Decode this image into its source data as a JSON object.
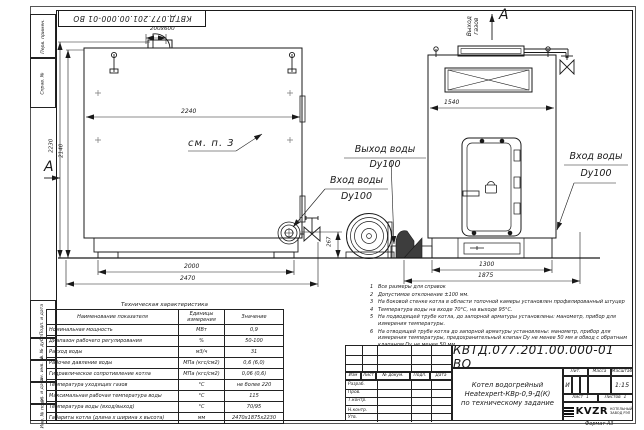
{
  "sheet": {
    "top_stamp": "КВТД.077.201.00.000-01 ВО",
    "format_note": "Формат А3",
    "side_labels": {
      "perv_primen": "Перв. примен.",
      "sprav_no": "Справ. №",
      "podp_data_1": "Подп. и дата",
      "inv_dubl": "Инв. № дубл.",
      "vzam_inv": "Взам. инв. №",
      "podp_data_2": "Подп. и дата",
      "inv_podl": "Инв. № подл."
    }
  },
  "drawing": {
    "left_view": {
      "dim_opening": "200x600",
      "dim_width_inner": "2240",
      "dim_height_overall": "2230",
      "dim_height_body": "2140",
      "dim_base": "2000",
      "dim_overall": "2470",
      "dim_flange_h": "267",
      "see_note": "см. п. 3",
      "section_label": "А"
    },
    "right_view": {
      "dim_width": "1540",
      "dim_base": "1300",
      "dim_overall": "1875",
      "flue_word1": "Выход",
      "flue_word2": "газов",
      "view_label": "А"
    },
    "callouts": {
      "water_out_line1": "Выход воды",
      "water_out_line2": "Dy100",
      "water_in_left_line1": "Вход воды",
      "water_in_left_line2": "Dy100",
      "water_in_right_line1": "Вход воды",
      "water_in_right_line2": "Dy100"
    }
  },
  "notes": {
    "items": [
      {
        "num": "1",
        "text": "Все размеры для справок"
      },
      {
        "num": "2",
        "text": "Допустимое отклонение ±100 мм."
      },
      {
        "num": "3",
        "text": "На боковой стенке котла в области топочной камеры установлен профилированный штуцер"
      },
      {
        "num": "4",
        "text": "Температура воды на входе 70°С, на выходе 95°С."
      },
      {
        "num": "5",
        "text": "На подводящей трубе котла, до запорной арматуры установлены: манометр, прибор для измерения температуры."
      },
      {
        "num": "6",
        "text": "На отводящей трубе котла до запорной арматуры установлены: манометр, прибор для измерения температуры, предохранительный клапан Dу не менее 50 мм и обвод с обратным клапаном Dу не менее 50 мм."
      },
      {
        "num": "7",
        "text": "Остальные технические требования по ОСТ 108.030.113-84"
      }
    ]
  },
  "spec_table": {
    "title": "Техническая характеристика",
    "headers": [
      "Наименование показателя",
      "Единицы измерения",
      "Значение"
    ],
    "rows": [
      [
        "Номинальная мощность",
        "МВт",
        "0,9"
      ],
      [
        "Диапазон рабочего регулирования",
        "%",
        "50-100"
      ],
      [
        "Расход воды",
        "м3/ч",
        "31"
      ],
      [
        "Рабочее давление воды",
        "МПа (кгс/см2)",
        "0,6 (6,0)"
      ],
      [
        "Гидравлическое сопротивление котла",
        "МПа (кгс/см2)",
        "0,06 (0,6)"
      ],
      [
        "Температура уходящих газов",
        "°С",
        "не более 220"
      ],
      [
        "Максимальная рабочая температура воды",
        "°С",
        "115"
      ],
      [
        "Температура воды (вход/выход)",
        "°С",
        "70/95"
      ],
      [
        "Габариты котла (длина х ширина х высота)",
        "мм",
        "2470х1875х2230"
      ]
    ]
  },
  "title_block": {
    "designation": "КВТД.077.201.00.000-01 ВО",
    "name_line1": "Котел водогрейный",
    "name_line2": "Heatexpert-КВр-0,9-Д(К)",
    "name_line3": "по техническому задание",
    "cols": {
      "izm": "Изм",
      "list": "Лист",
      "ndocum": "№ докум.",
      "podp": "Подп.",
      "data": "Дата"
    },
    "rows": {
      "razrab": "Разраб.",
      "prov": "Пров.",
      "tkontr": "Т.контр.",
      "nkontr": "Н.контр.",
      "utv": "Утв."
    },
    "lit_label": "Лит.",
    "mass_label": "Масса",
    "scale_label": "Масштаб",
    "lit_value": "И",
    "scale_value": "1:15",
    "sheet_label": "Лист",
    "sheet_value": "1",
    "sheets_label": "Листов",
    "sheets_value": "1",
    "company_logo": "KVZR",
    "company_line1": "КОТЕЛЬНЫЙ",
    "company_line2": "ЗАВОД РЭП"
  }
}
